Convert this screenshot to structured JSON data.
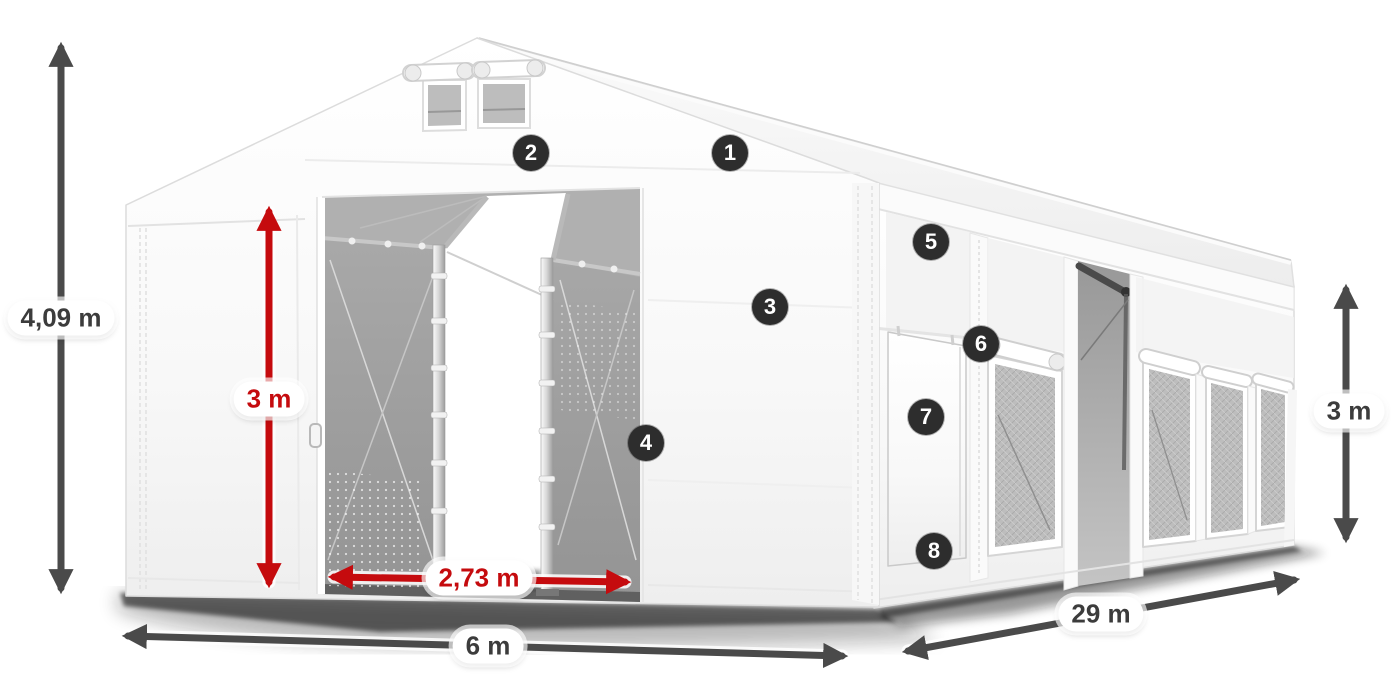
{
  "dimensions": {
    "total_height": {
      "value": "4,09 m"
    },
    "door_height": {
      "value": "3 m"
    },
    "door_width": {
      "value": "2,73 m"
    },
    "width": {
      "value": "6 m"
    },
    "length": {
      "value": "29 m"
    },
    "side_height": {
      "value": "3 m"
    }
  },
  "markers": [
    {
      "label": "1"
    },
    {
      "label": "2"
    },
    {
      "label": "3"
    },
    {
      "label": "4"
    },
    {
      "label": "5"
    },
    {
      "label": "6"
    },
    {
      "label": "7"
    },
    {
      "label": "8"
    }
  ],
  "colors": {
    "dimension_red": "#c50b0e",
    "dimension_gray": "#4a4a4a",
    "marker_background": "#2d2d2d",
    "marker_text": "#ffffff",
    "label_background": "#ffffff",
    "label_text": "#3c3c3c",
    "tent_white": "#fefefe",
    "interior_mesh_gray": "#a0a0a0"
  }
}
